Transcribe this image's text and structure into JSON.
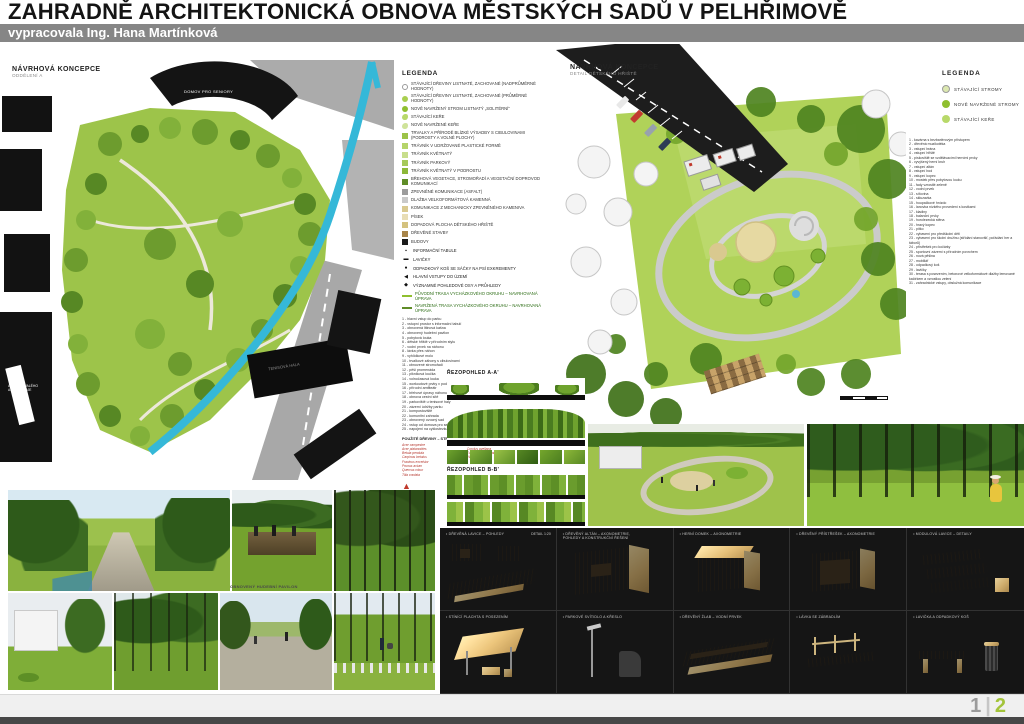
{
  "header": {
    "title": "ZAHRADNĚ ARCHITEKTONICKÁ OBNOVA MĚSTSKÝCH SADŮ V PELHŘIMOVĚ",
    "subtitle": "vypracovala Ing. Hana Martínková"
  },
  "left_plan": {
    "title": "NÁVRHOVÁ KONCEPCE",
    "subtitle": "ODDĚLENÍ A",
    "labels": {
      "seniors": "DOMOV PRO SENIORY",
      "tennis": "TENISOVÁ HALA",
      "areal_line1": "AREÁL BÝVALÉHO",
      "areal_line2": "AGROSTROJE"
    }
  },
  "right_plan": {
    "title": "NÁVRHOVÁ KONCEPCE",
    "subtitle": "DETAIL DĚTSKÉHO HŘIŠTĚ"
  },
  "legend_main": {
    "title": "LEGENDA",
    "items": [
      {
        "shape": "circle",
        "color": "#ffffff",
        "border": "#9a9a9a",
        "label": "STÁVAJÍCÍ DŘEVINY LISTNATÉ, ZACHOVANÉ (NADPRŮMĚRNÉ HODNOTY)"
      },
      {
        "shape": "circle",
        "color": "#a9cf4f",
        "label": "STÁVAJÍCÍ DŘEVINY LISTNATÉ, ZACHOVANÉ (PRŮMĚRNÉ HODNOTY)"
      },
      {
        "shape": "circle",
        "color": "#8fbf2f",
        "label": "NOVĚ NAVRŽENÝ STROM LISTNATÝ „SOLITÉRNÍ“"
      },
      {
        "shape": "blob",
        "color": "#b8d96a",
        "label": "STÁVAJÍCÍ KEŘE"
      },
      {
        "shape": "blob",
        "color": "#cfe39a",
        "label": "NOVĚ NAVRŽENÉ KEŘE"
      },
      {
        "shape": "square",
        "color": "#9cc348",
        "label": "TRVALKY A PŘÍRODĚ BLÍZKÉ VÝSADBY S CIBULOVINAMI (podrosty a volné plochy)"
      },
      {
        "shape": "square",
        "color": "#b5d46a",
        "label": "TRÁVNÍK V UDRŽOVANÉ PLASTICKÉ FORMĚ"
      },
      {
        "shape": "square",
        "color": "#c8de8c",
        "label": "TRÁVNÍK KVĚTNATÝ"
      },
      {
        "shape": "square",
        "color": "#a6c95a",
        "label": "TRÁVNÍK PARKOVÝ"
      },
      {
        "shape": "square",
        "color": "#8db839",
        "label": "TRÁVNÍK KVĚTNATÝ V PODROSTU"
      },
      {
        "shape": "square",
        "color": "#5f8c27",
        "label": "BŘEHOVÁ VEGETACE, STROMOŘADÍ A VEGETAČNÍ DOPROVOD KOMUNIKACÍ"
      },
      {
        "shape": "square",
        "color": "#9c9c9c",
        "label": "ZPEVNĚNÉ KOMUNIKACE (ASFALT)"
      },
      {
        "shape": "square",
        "color": "#c9c9c9",
        "label": "DLAŽBA VELKOFORMÁTOVÁ KAMENNÁ"
      },
      {
        "shape": "square",
        "color": "#d9c98f",
        "label": "KOMUNIKACE Z MECHANICKY ZPEVNĚNÉHO KAMENIVA"
      },
      {
        "shape": "square",
        "color": "#e8ddb5",
        "label": "PÍSEK"
      },
      {
        "shape": "square",
        "color": "#d4c27f",
        "label": "DOPADOVÁ PLOCHA DĚTSKÉHO HŘIŠTĚ"
      },
      {
        "shape": "square",
        "color": "#a8854a",
        "label": "DŘEVĚNÉ STAVBY"
      },
      {
        "shape": "square",
        "color": "#1a1a1a",
        "label": "BUDOVY"
      }
    ],
    "symbols": [
      {
        "glyph": "▪",
        "label": "INFORMAČNÍ TABULE"
      },
      {
        "glyph": "▬",
        "label": "LAVIČKY"
      },
      {
        "glyph": "●",
        "label": "ODPADKOVÝ KOŠ SE SÁČKY NA PSÍ EXKREMENTY"
      },
      {
        "glyph": "◀",
        "label": "HLAVNÍ VSTUPY DO ÚZEMÍ"
      },
      {
        "glyph": "◆",
        "label": "VÝZNAMNÉ POHLEDOVÉ OSY A PRŮHLEDY"
      }
    ],
    "routes": [
      {
        "color": "#8fbf2f",
        "label": "PŮVODNÍ TRASA VYCHÁZKOVÉHO OKRUHU – NAVRHOVANÁ ÚPRAVA"
      },
      {
        "color": "#5f8c27",
        "label": "NAVRŽENÁ TRASA VYCHÁZKOVÉHO OKRUHU – NAVRHOVANÁ ÚPRAVA"
      }
    ],
    "numbered": [
      "1 - hlavní vstup do parku",
      "2 - vstupní prostor s informační tabulí",
      "3 - obnovená litinová kašna",
      "4 - obnovený hudební pavilon",
      "5 - pobytová louka",
      "6 - dětské hřiště v přírodním stylu",
      "7 - vodní prvek na náhonu",
      "8 - lávka přes náhon",
      "9 - vyhlídkové molo",
      "10 - trvalkové záhony s cibulovinami",
      "11 - obnovené stromořadí",
      "12 - pěší promenáda",
      "13 - pikniková loučka",
      "14 - volnočasová louka",
      "15 - workoutové prvky v podrostu",
      "16 - přírodní amfiteátr",
      "17 - břehové úpravy náhonu",
      "18 - obnova cestní sítě",
      "19 - parkoviště u tenisové haly",
      "20 - zázemí údržby parku",
      "21 - kompostoviště",
      "22 - komunitní zahrada",
      "23 - obnovený ovocný sad",
      "24 - vstup od domova pro seniory",
      "25 - napojení na cyklostezku"
    ],
    "plants": {
      "header_left": "POUŽITÉ DŘEVINY – STROMY",
      "left": [
        "Acer campestre",
        "Acer platanoides",
        "Betula pendula",
        "Carpinus betulus",
        "Fraxinus excelsior",
        "Prunus avium",
        "Quercus robur",
        "Tilia cordata"
      ],
      "header_right": "POUŽITÉ DŘEVINY – KEŘE",
      "right": [
        "Cornus mas",
        "Corylus avellana",
        "Euonymus europaeus",
        "Viburnum opulus"
      ]
    }
  },
  "sections": {
    "a_label": "ŘEZOPOHLED A-A'",
    "b_label": "ŘEZOPOHLED B-B'"
  },
  "legend_detail": {
    "title": "LEGENDA",
    "items": [
      {
        "color": "#dce8b0",
        "border": "#9a9a9a",
        "label": "STÁVAJÍCÍ STROMY"
      },
      {
        "color": "#8fbf2f",
        "label": "NOVĚ NAVRŽENÉ STROMY"
      },
      {
        "color": "#b8d96a",
        "label": "STÁVAJÍCÍ KEŘE"
      }
    ],
    "numbered": [
      "1 - kavárna s bezbariérovým přístupem",
      "2 - dřevěná muzikotéka",
      "3 - vstupní brána",
      "4 - vstupní hřiště",
      "5 - pískoviště se vzdělávacími herními prvky",
      "6 - vyvýšený herní kruh",
      "7 - vstupní altán",
      "8 - vstupní bod",
      "9 - vstupní kopec",
      "10 - mostek přes pobytovou louku",
      "11 - řady vzrostlé zeleně",
      "12 - vodní prvek",
      "13 - síťovina",
      "14 - skluzavka",
      "15 - houpačkové hnízdo",
      "16 - lanovka nízkého provedení s kostkami",
      "17 - kladiny",
      "18 - balanční prvky",
      "19 - horolezecká stěna",
      "20 - hravý kopec",
      "21 - pítko",
      "22 - vybavení pro předškolní děti",
      "23 - vybavení pro školní družinu (střídání stanovišť, pořádání her a táborů)",
      "24 - přístřešek pro kočárky",
      "25 - sportovní zázemí s přírodním povrchem",
      "26 - nová pěšina",
      "27 - mobiliář",
      "28 - odpadkový koš",
      "29 - lavičky",
      "30 - terasa s posezením, betonové velkoformátové dlažby lemované kačírkem a vzrostlou zelení",
      "31 - zahradnické vstupy, obslužná komunikace"
    ]
  },
  "photos": {
    "caption": "OBNOVENÝ HUDEBNÍ PAVILON"
  },
  "panel": {
    "cells": [
      {
        "caption": "• DŘEVĚNÁ LAVICE – POHLEDY",
        "right": "DETAIL 1:20"
      },
      {
        "caption": "• DŘEVĚNÝ ALTÁN – AXONOMETRIE, POHLEDY A KONSTRUKČNÍ ŘEŠENÍ"
      },
      {
        "caption": "• HERNÍ DOMEK – AXONOMETRIE"
      },
      {
        "caption": "• DŘEVĚNÝ PŘÍSTŘEŠEK – AXONOMETRIE"
      },
      {
        "caption": "• MODULOVÁ LAVICE – DETAILY"
      },
      {
        "caption": "• STÍNÍCÍ PLACHTA S POSEZENÍM"
      },
      {
        "caption": "• PARKOVÉ SVÍTIDLO A KŘESLO"
      },
      {
        "caption": "• DŘEVĚNÝ ŽLAB – VODNÍ PRVEK"
      },
      {
        "caption": "• LÁVKA SE ZÁBRADLÍM"
      },
      {
        "caption": "• LAVIČKA A ODPADKOVÝ KOŠ"
      }
    ]
  },
  "footer": {
    "page_current": "1",
    "separator": "|",
    "page_next": "2"
  }
}
